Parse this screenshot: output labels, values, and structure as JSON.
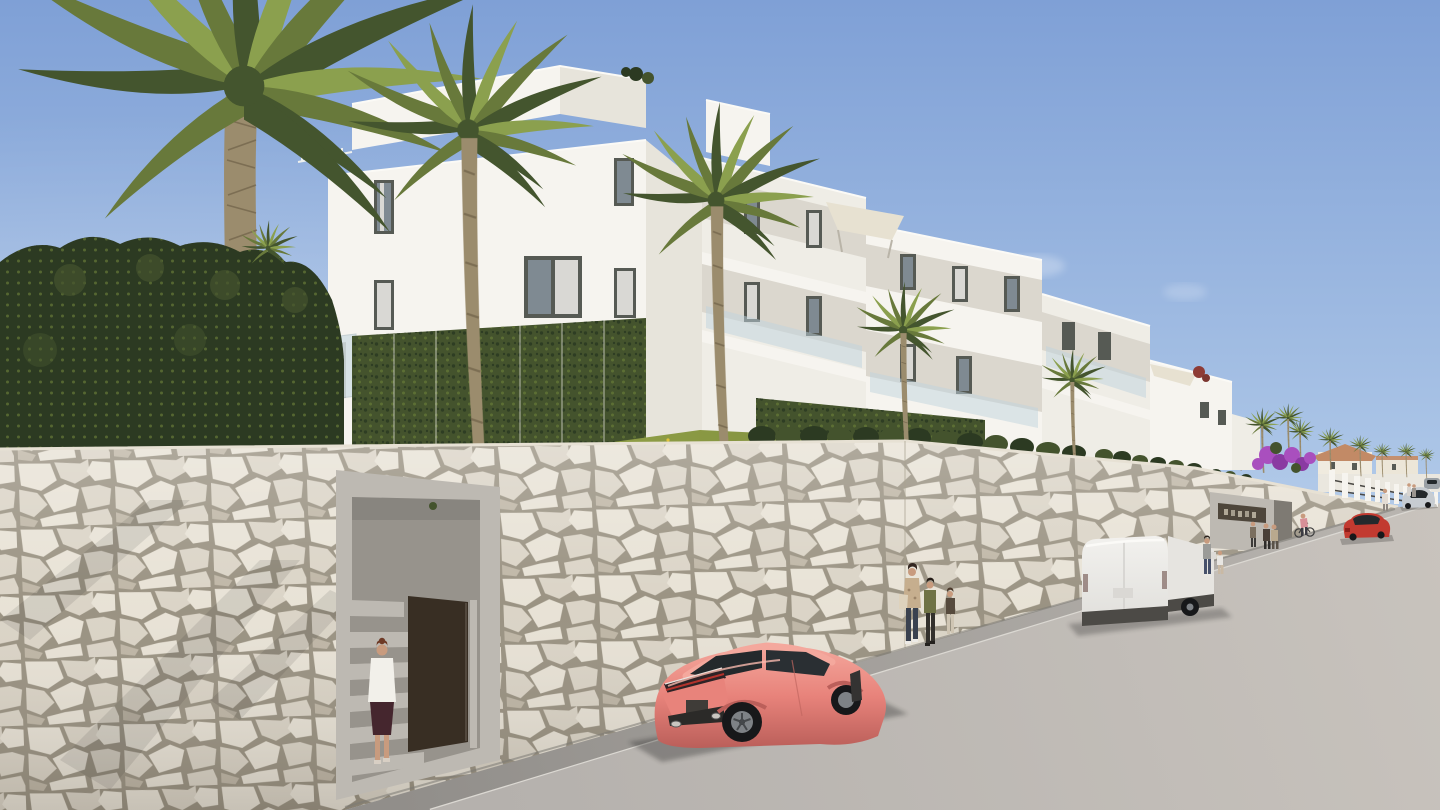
{
  "scene": {
    "title": "New-build apartment complex street view",
    "description": "Photorealistic 3D architectural render: modern white apartment blocks stepping down a hillside behind a natural stone retaining wall, tall palm trees, a recessed pedestrian entrance with stairs and open dark gate where a woman walks in, a coral sports coupe and a white cargo van parked on an uphill street, pedestrians on the sidewalk, distant villas, white fence pillars and cars under a clear blue sky.",
    "style": "3D exterior render, daytime, clear sky",
    "entrance_plaque": {
      "legible": false
    }
  },
  "colors": {
    "sky_top": "#7fa0d6",
    "sky_mid": "#aac4e6",
    "sky_low": "#ddeaf6",
    "cloud": "#ffffff",
    "building_front": "#f6f4ef",
    "building_front2": "#efede6",
    "building_side": "#e7e4db",
    "building_recess": "#dbd7ce",
    "building_under": "#c9c5bc",
    "window_frame": "#565a54",
    "window_glass": "#7f8a92",
    "window_dark": "#39414a",
    "curtain": "#d9d8d4",
    "balcony_glass": "#bfd4de",
    "rail": "#eef0ee",
    "sail": "#e7e1d1",
    "hedge_dark": "#2c3a22",
    "hedge_mid": "#44532d",
    "hedge_light": "#5f7235",
    "grass": "#7d8c3c",
    "grass_light": "#9cab4e",
    "flower": "#e2c23c",
    "palm_trunk": "#9b8c6d",
    "palm_trunk_dark": "#6f6148",
    "frond_dark": "#44552e",
    "frond_mid": "#68793b",
    "frond_light": "#8ba04e",
    "stone": "#d9d2c4",
    "stone_light": "#e7e1d4",
    "stone_dark": "#bcb3a2",
    "mortar": "#958d7c",
    "concrete": "#bdb9b2",
    "concrete_dark": "#97938c",
    "concrete_deep": "#7e7a73",
    "road": "#c8c3bd",
    "road_near": "#b5b1ad",
    "sidewalk": "#b9b5b0",
    "sidewalk_near": "#918e8a",
    "curb": "#dbd8d2",
    "coral": "#e8837b",
    "coral_light": "#f4a89d",
    "coral_dark": "#bb5f5a",
    "car_glass": "#24292c",
    "tire": "#17181a",
    "rim": "#7e8286",
    "van": "#f2f1ee",
    "van_shade": "#e0dfdb",
    "van_trim": "#4c4a46",
    "red_car": "#c23a30",
    "silver_car": "#c7ccd1",
    "grey_car": "#9aa0a5",
    "gate": "#382e23",
    "plaque": "#4e463b",
    "plaque_mark": "#c9c1af",
    "skin": "#c89b7e",
    "hair": "#6e3a26",
    "blouse": "#f2f0ea",
    "skirt": "#45262e",
    "shadow": "#1f1f1d",
    "bougainvillea": "#a94fbe",
    "bougainvillea_dark": "#8a3aa2"
  },
  "objects": [
    {
      "name": "apartment-building",
      "color_key": "building_front",
      "floors": 3
    },
    {
      "name": "penthouse-roof-terrace"
    },
    {
      "name": "shade-sail",
      "count": 2,
      "color_key": "sail"
    },
    {
      "name": "palm-tree",
      "count": 6,
      "plus_distant": 7
    },
    {
      "name": "boxwood-hedge"
    },
    {
      "name": "climbing-ivy-trellis"
    },
    {
      "name": "grass-slope-with-flowers"
    },
    {
      "name": "stone-retaining-wall",
      "color_key": "stone"
    },
    {
      "name": "pedestrian-entrance-stairs"
    },
    {
      "name": "entrance-gate",
      "color_key": "gate",
      "state": "open"
    },
    {
      "name": "entrance-plaque",
      "color_key": "plaque",
      "legible": false
    },
    {
      "name": "woman-entering",
      "colors": [
        "blouse",
        "skirt",
        "hair"
      ]
    },
    {
      "name": "coral-sports-coupe",
      "color_key": "coral",
      "parked": true
    },
    {
      "name": "white-cargo-van",
      "color_key": "van",
      "parked": true
    },
    {
      "name": "red-car-driving",
      "color_key": "red_car"
    },
    {
      "name": "silver-car-parked",
      "color_key": "silver_car"
    },
    {
      "name": "grey-car-distant",
      "color_key": "grey_car"
    },
    {
      "name": "pedestrian-group",
      "count": 3
    },
    {
      "name": "man-with-child",
      "count": 2
    },
    {
      "name": "distant-pedestrians",
      "count": 5
    },
    {
      "name": "cyclist-walking-bike"
    },
    {
      "name": "bougainvillea",
      "color_key": "bougainvillea"
    },
    {
      "name": "white-fence-pillars"
    },
    {
      "name": "distant-villas"
    },
    {
      "name": "uphill-street"
    },
    {
      "name": "sidewalk"
    }
  ]
}
